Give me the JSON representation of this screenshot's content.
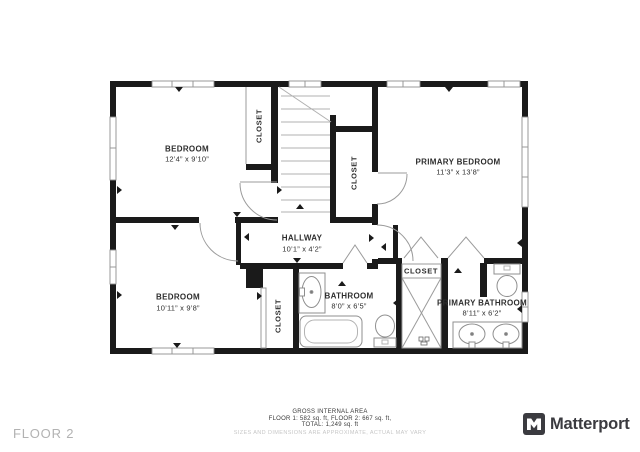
{
  "floor_label": "FLOOR 2",
  "rooms": {
    "bedroom1": {
      "name": "BEDROOM",
      "dims": "12’4” x 9’10”"
    },
    "primary_bedroom": {
      "name": "PRIMARY BEDROOM",
      "dims": "11’3” x 13’8”"
    },
    "bedroom2": {
      "name": "BEDROOM",
      "dims": "10’11” x 9’8”"
    },
    "hallway": {
      "name": "HALLWAY",
      "dims": "10’1” x 4’2”"
    },
    "bathroom": {
      "name": "BATHROOM",
      "dims": "8’0” x 6’5”"
    },
    "primary_bathroom": {
      "name": "PRIMARY BATHROOM",
      "dims": "8’11” x 6’2”"
    },
    "closet_label": "CLOSET"
  },
  "footer": {
    "line1": "GROSS INTERNAL AREA",
    "line2": "FLOOR 1: 582 sq. ft, FLOOR 2: 667 sq. ft,",
    "line3": "TOTAL: 1,249 sq. ft",
    "disclaimer": "SIZES AND DIMENSIONS ARE APPROXIMATE, ACTUAL MAY VARY"
  },
  "brand": {
    "name": "Matterport"
  },
  "colors": {
    "wall": "#1a1a1a",
    "thin_line": "#9b9b9b",
    "label_text": "#2d2d2d",
    "muted_text": "#c7c7c7",
    "brand_dark": "#3b3b40"
  }
}
